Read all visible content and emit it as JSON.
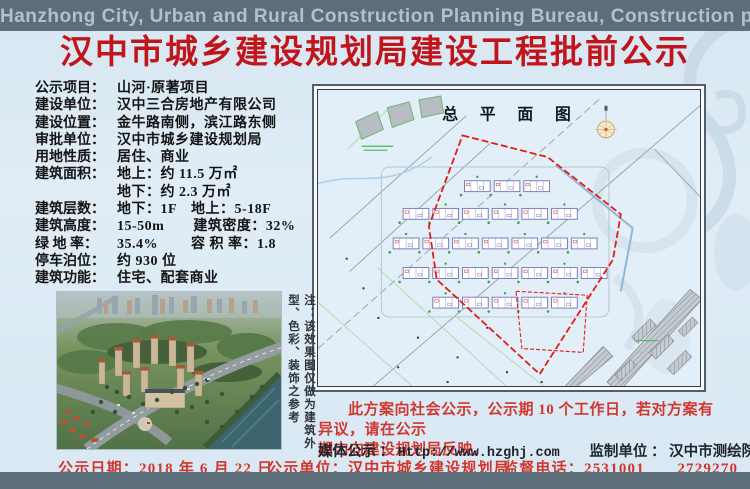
{
  "banner": {
    "text": "Hanzhong City, Urban and Rural Construction Planning Bureau, Construction publicity"
  },
  "page_title": "汉中市城乡建设规划局建设工程批前公示",
  "info_rows": [
    {
      "label": "公示项目：",
      "value": "山河·原著项目"
    },
    {
      "label": "建设单位：",
      "value": "汉中三合房地产有限公司"
    },
    {
      "label": "建设位置：",
      "value": "金牛路南侧，滨江路东侧"
    },
    {
      "label": "审批单位：",
      "value": "汉中市城乡建设规划局"
    },
    {
      "label": "用地性质：",
      "value": "居住、商业"
    },
    {
      "label": "建筑面积：",
      "value": "地上：约 11.5 万㎡"
    },
    {
      "label": "",
      "value": "地下：约 2.3 万㎡"
    },
    {
      "label": "建筑层数：",
      "value": "地下：1F　地上：5-18F"
    },
    {
      "label": "建筑高度：",
      "value": "15-50m　　建筑密度：32%"
    },
    {
      "label": "绿 地 率：",
      "value": "35.4%　　 容 积 率：1.8"
    },
    {
      "label": "停车泊位：",
      "value": "约 930 位"
    },
    {
      "label": "建筑功能：",
      "value": "住宅、配套商业"
    }
  ],
  "site_plan": {
    "title": "总 平 面 图"
  },
  "render_note": "注：该效果图仅做为建筑外型、色彩、装饰之参考",
  "notice_lines": [
    "此方案向社会公示，公示期 10 个工作日，若对方案有异议，请在公示",
    "期内向建设规划局反映。"
  ],
  "media_row": {
    "media_label": "媒体公示 ：",
    "media_url": "Http://www.hzghj.com",
    "producer_label": "监制单位 ：",
    "producer_value": "汉中市测绘院"
  },
  "footer_row": {
    "date_label": "公示日期：",
    "date_value": "2018 年 6 月 22 日",
    "unit_label": "公示单位：",
    "unit_value": "汉中市城乡建设规划局",
    "phone_label": "监督电话：",
    "phone_value": "2531001　　2729270"
  },
  "colors": {
    "banner_bg": "#5b6e79",
    "page_bg": "#dcebf4",
    "title_red": "#c0151a",
    "notice_red": "#cf382f",
    "footer_red": "#d1352b",
    "info_text": "#141414",
    "media_text": "#1d2530",
    "plan_boundary_red": "#e31b12",
    "plan_bg": "#e3eff8"
  }
}
